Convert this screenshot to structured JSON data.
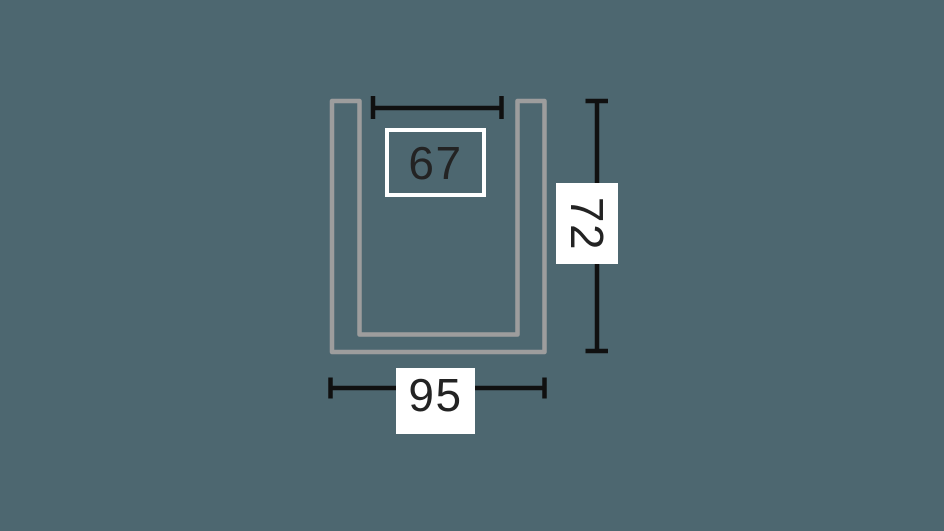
{
  "diagram": {
    "kind": "furniture-dimension-top-view",
    "shape": "u-outline",
    "labels": {
      "inner_width": "67",
      "depth": "72",
      "outer_width": "95"
    },
    "colors": {
      "background": "#4d6770",
      "outline": "#9d9d9d",
      "dimension_line": "#101010",
      "label_box": "#ffffff",
      "label_text": "#232323"
    }
  }
}
